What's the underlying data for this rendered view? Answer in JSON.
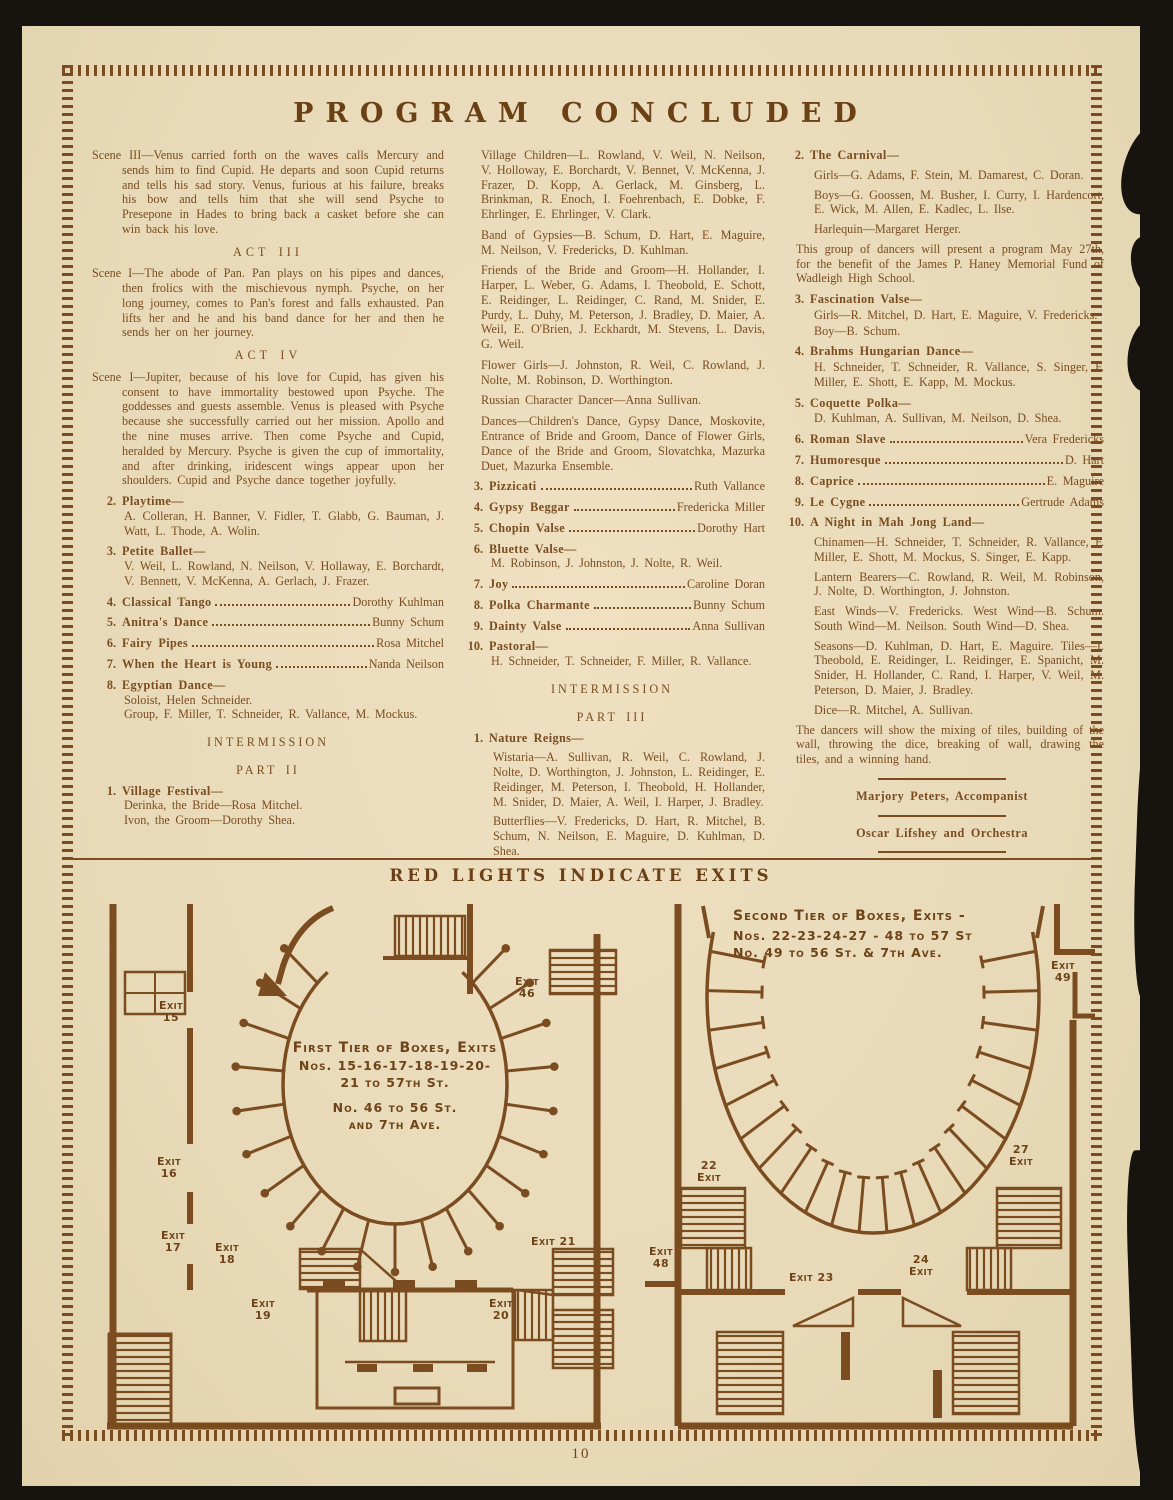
{
  "colors": {
    "paper": "#e9dbba",
    "ink": "#7a4c20",
    "ink_dark": "#6b4015",
    "background": "#17130e"
  },
  "header": {
    "title": "PROGRAM  CONCLUDED"
  },
  "footer": {
    "page_number": "10"
  },
  "column1": {
    "scene3": "Scene III—Venus carried forth on the waves calls Mercury and sends him to find Cupid.  He departs and soon Cupid returns and tells his sad story.  Venus, furious at his failure, breaks his bow and tells him that she will send Psyche to Presepone in Hades to bring back a casket before she can win back his love.",
    "act3_heading": "ACT  III",
    "act3_scene": "Scene I—The abode of Pan.  Pan plays on his pipes and dances, then frolics with the mischievous nymph.  Psyche, on her long journey, comes to Pan's forest and falls exhausted.  Pan lifts her and he and his band dance for her and then he sends her on her journey.",
    "act4_heading": "ACT  IV",
    "act4_scene": "Scene I—Jupiter, because of his love for Cupid, has given his consent to have immortality bestowed upon Psyche.  The goddesses and guests assemble.  Venus is pleased with Psyche because she successfully carried out her mission.  Apollo and the nine muses arrive. Then come Psyche and Cupid, heralded by Mercury.  Psyche is given the cup of immortality, and after drinking, iridescent wings appear upon her shoulders.  Cupid and Psyche dance together joyfully.",
    "item2_num": "2.",
    "item2_title": "Playtime—",
    "item2_names": "A. Colleran, H. Banner, V. Fidler, T. Glabb, G. Bauman, J. Watt, L. Thode, A. Wolin.",
    "item3_num": "3.",
    "item3_title": "Petite Ballet—",
    "item3_names": "V. Weil, L. Rowland, N. Neilson, V. Hollaway, E. Borchardt, V. Bennett, V. McKenna, A. Gerlach, J. Frazer.",
    "item4_num": "4.",
    "item4_title": "Classical Tango",
    "item4_name": "Dorothy Kuhlman",
    "item5_num": "5.",
    "item5_title": "Anitra's Dance",
    "item5_name": "Bunny Schum",
    "item6_num": "6.",
    "item6_title": "Fairy Pipes",
    "item6_name": "Rosa Mitchel",
    "item7_num": "7.",
    "item7_title": "When the Heart is Young",
    "item7_name": "Nanda Neilson",
    "item8_num": "8.",
    "item8_title": "Egyptian Dance—",
    "item8_line1": "Soloist, Helen Schneider.",
    "item8_line2": "Group, F. Miller, T. Schneider, R. Vallance, M. Mockus.",
    "intermission": "INTERMISSION",
    "part2": "PART  II",
    "p2item1_num": "1.",
    "p2item1_title": "Village Festival—",
    "p2item1_line1": "Derinka, the Bride—Rosa Mitchel.",
    "p2item1_line2": "Ivon, the Groom—Dorothy Shea."
  },
  "column2": {
    "village_children": "Village Children—L. Rowland, V. Weil, N. Neilson, V. Holloway, E. Borchardt, V. Bennet, V. McKenna, J. Frazer, D. Kopp, A. Gerlack, M. Ginsberg, L. Brinkman, R. Enoch, I. Foehrenbach, E. Dobke, F. Ehrlinger, E. Ehrlinger, V. Clark.",
    "band_of_gypsies": "Band of Gypsies—B. Schum, D. Hart, E. Maguire, M. Neilson, V. Fredericks, D. Kuhlman.",
    "friends": "Friends of the Bride and Groom—H. Hollander, I. Harper, L. Weber, G. Adams, I. Theobold, E. Schott, E. Reidinger, L. Reidinger, C. Rand, M. Snider, E. Purdy, L. Duhy, M. Peterson, J. Bradley, D. Maier, A. Weil, E. O'Brien, J. Eckhardt, M. Stevens, L. Davis, G. Weil.",
    "flower_girls": "Flower Girls—J. Johnston, R. Weil, C. Rowland, J. Nolte, M. Robinson, D. Worthington.",
    "russian_dancer": "Russian Character Dancer—Anna Sullivan.",
    "dances": "Dances—Children's Dance, Gypsy Dance, Moskovite, Entrance of Bride and Groom, Dance of Flower Girls, Dance of the Bride and Groom, Slovatchka, Mazurka Duet, Mazurka Ensemble.",
    "item3_num": "3.",
    "item3_title": "Pizzicati",
    "item3_name": "Ruth Vallance",
    "item4_num": "4.",
    "item4_title": "Gypsy Beggar",
    "item4_name": "Fredericka Miller",
    "item5_num": "5.",
    "item5_title": "Chopin Valse",
    "item5_name": "Dorothy Hart",
    "item6_num": "6.",
    "item6_title": "Bluette Valse—",
    "item6_names": "M. Robinson, J. Johnston, J. Nolte, R. Weil.",
    "item7_num": "7.",
    "item7_title": "Joy",
    "item7_name": "Caroline Doran",
    "item8_num": "8.",
    "item8_title": "Polka Charmante",
    "item8_name": "Bunny Schum",
    "item9_num": "9.",
    "item9_title": "Dainty Valse",
    "item9_name": "Anna Sullivan",
    "item10_num": "10.",
    "item10_title": "Pastoral—",
    "item10_names": "H. Schneider, T. Schneider, F. Miller, R. Vallance.",
    "intermission": "INTERMISSION",
    "part3": "PART  III",
    "nr_num": "1.",
    "nr_title": "Nature Reigns—",
    "wistaria": "Wistaria—A. Sullivan, R. Weil, C. Rowland, J. Nolte, D. Worthington, J. Johnston, L. Reidinger, E. Reidinger, M. Peterson, I. Theobold, H. Hollander, M. Snider, D. Maier, A. Weil, I. Harper, J. Bradley.",
    "butterflies": "Butterflies—V. Fredericks, D. Hart, R. Mitchel, B. Schum, N. Neilson, E. Maguire, D. Kuhlman, D. Shea.",
    "dragon_flies": "Dragon Flies—H. Schneider, S. Singer, F. Miller, T. Schneider, L. Davis, E. Schott, M. Mockus, R. Vallance, E. Kapp."
  },
  "column3": {
    "carnival_num": "2.",
    "carnival_title": "The Carnival—",
    "carnival_girls": "Girls—G. Adams, F. Stein, M. Damarest, C. Doran.",
    "carnival_boys": "Boys—G. Goossen, M. Busher, I. Curry, I. Hardencort, E. Wick, M. Allen, E. Kadlec, L. Ilse.",
    "carnival_harlequin": "Harlequin—Margaret Herger.",
    "carnival_note": "This group of dancers will present a program May 27th, for the benefit of the James P. Haney Memorial Fund of Wadleigh High School.",
    "fasc_num": "3.",
    "fasc_title": "Fascination Valse—",
    "fasc_girls": "Girls—R. Mitchel, D. Hart, E. Maguire, V. Fredericks.",
    "fasc_boy": "Boy—B. Schum.",
    "brahms_num": "4.",
    "brahms_title": "Brahms Hungarian Dance—",
    "brahms_names": "H. Schneider, T. Schneider, R. Vallance, S. Singer, F. Miller, E. Shott, E. Kapp, M. Mockus.",
    "coq_num": "5.",
    "coq_title": "Coquette Polka—",
    "coq_names": "D. Kuhlman, A. Sullivan, M. Neilson, D. Shea.",
    "item6_num": "6.",
    "item6_title": "Roman Slave",
    "item6_name": "Vera Fredericks",
    "item7_num": "7.",
    "item7_title": "Humoresque",
    "item7_name": "D. Hart",
    "item8_num": "8.",
    "item8_title": "Caprice",
    "item8_name": "E. Maguire",
    "item9_num": "9.",
    "item9_title": "Le Cygne",
    "item9_name": "Gertrude Adams",
    "mj_num": "10.",
    "mj_title": "A Night in Mah Jong Land—",
    "mj_chinamen": "Chinamen—H. Schneider, T. Schneider, R. Vallance, F. Miller, E. Shott, M. Mockus, S. Singer, E. Kapp.",
    "mj_lantern": "Lantern Bearers—C. Rowland, R. Weil, M. Robinson, J. Nolte, D. Worthington, J. Johnston.",
    "mj_winds": "East Winds—V. Fredericks.  West Wind—B. Schum.  South Wind—M. Neilson.  South Wind—D. Shea.",
    "mj_seasons": "Seasons—D. Kuhlman, D. Hart, E. Maguire. Tiles—I. Theobold, E. Reidinger, L. Reidinger, E. Spanicht, M. Snider, H. Hollander, C. Rand, I. Harper, V. Weil, M. Peterson, D. Maier, J. Bradley.",
    "mj_dice": "Dice—R. Mitchel, A. Sullivan.",
    "mj_note": "The dancers will show the mixing of tiles, building of the wall, throwing the dice, breaking of wall, drawing the tiles, and a winning hand.",
    "credit1": "Marjory Peters, Accompanist",
    "credit2": "Oscar Lifshey and Orchestra",
    "credit3": "Steinway Piano Used"
  },
  "exits": {
    "heading": "RED LIGHTS INDICATE EXITS",
    "first_tier": {
      "center_lines": [
        "First Tier of Boxes, Exits",
        "Nos. 15-16-17-18-19-20-",
        "21 to 57th St.",
        "No. 46 to 56 St.",
        "and 7th Ave."
      ],
      "exit_labels": [
        "Exit 15",
        "Exit 16",
        "Exit 17",
        "Exit 18",
        "Exit 19",
        "Exit 46",
        "Exit 21",
        "Exit 20"
      ]
    },
    "second_tier": {
      "header_lines": [
        "Second Tier of Boxes, Exits -",
        "Nos. 22-23-24-27 - 48 to 57 St",
        "No. 49 to 56 St. & 7th Ave."
      ],
      "exit_labels": [
        "Exit 49",
        "22 Exit",
        "Exit 48",
        "Exit 23",
        "24 Exit",
        "27 Exit"
      ]
    }
  }
}
